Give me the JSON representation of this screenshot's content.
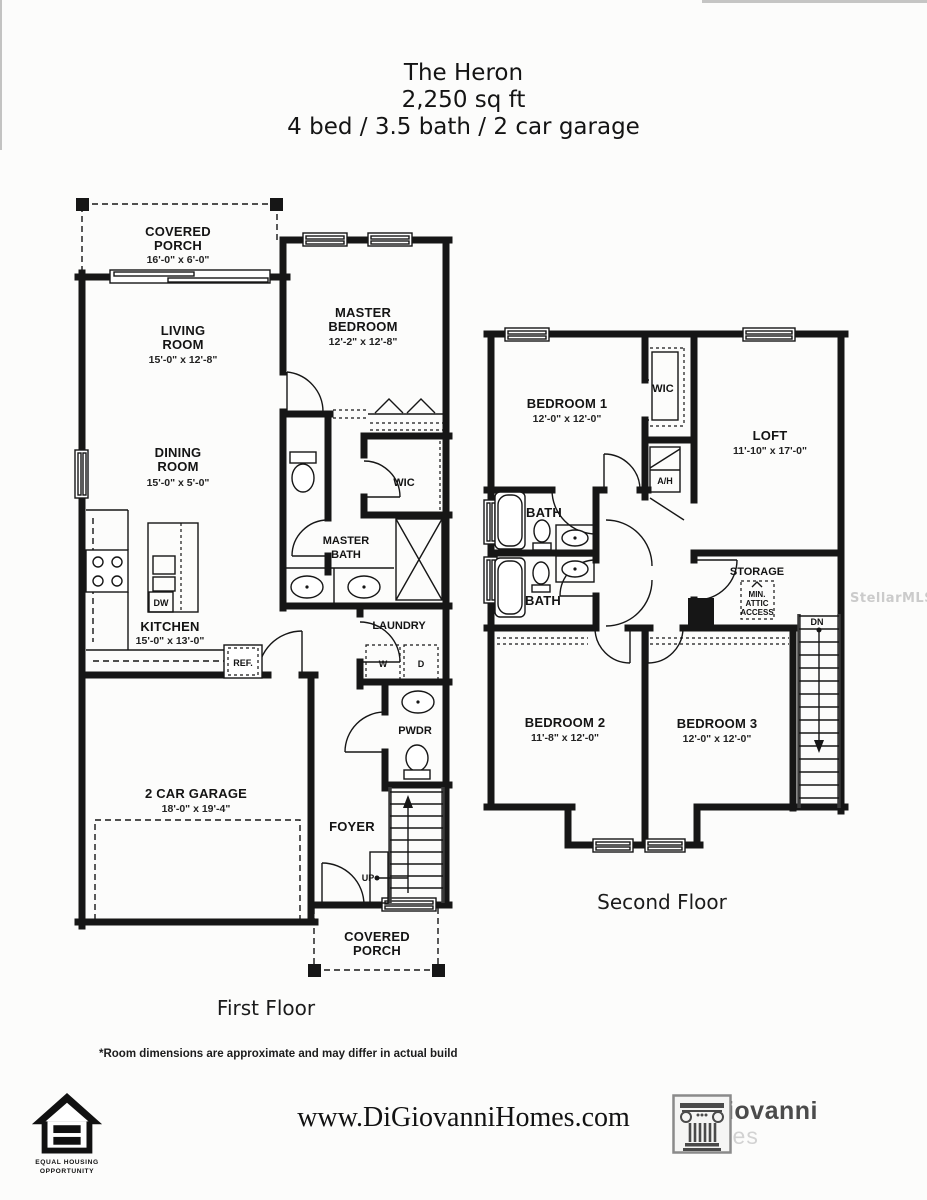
{
  "theme": {
    "ink": "#161616",
    "paper": "#fcfcfb",
    "watermark_color": "#cbcbcb",
    "brand_gray": "#4b4b4b",
    "brand_light_gray": "#d2d2d2"
  },
  "header": {
    "line1": "The Heron",
    "line2": "2,250 sq ft",
    "line3": "4 bed / 3.5 bath / 2 car garage"
  },
  "watermark": "StellarMLS",
  "first_floor": {
    "caption": "First Floor",
    "porch_top": {
      "l1": "COVERED",
      "l2": "PORCH",
      "dims": "16'-0\" x 6'-0\""
    },
    "living": {
      "l1": "LIVING",
      "l2": "ROOM",
      "dims": "15'-0\" x 12'-8\""
    },
    "master_bedroom": {
      "l1": "MASTER",
      "l2": "BEDROOM",
      "dims": "12'-2\" x 12'-8\""
    },
    "dining": {
      "l1": "DINING",
      "l2": "ROOM",
      "dims": "15'-0\" x 5'-0\""
    },
    "wic": "WIC",
    "master_bath": {
      "l1": "MASTER",
      "l2": "BATH"
    },
    "kitchen": {
      "l1": "KITCHEN",
      "dims": "15'-0\" x 13'-0\""
    },
    "dishwasher": "DW",
    "fridge": "REF.",
    "laundry": "LAUNDRY",
    "washer": "W",
    "dryer": "D",
    "pwdr": "PWDR",
    "garage": {
      "l1": "2 CAR GARAGE",
      "dims": "18'-0\" x 19'-4\""
    },
    "foyer": "FOYER",
    "up": "UP",
    "porch_bottom": {
      "l1": "COVERED",
      "l2": "PORCH"
    }
  },
  "second_floor": {
    "caption": "Second Floor",
    "bedroom1": {
      "l1": "BEDROOM 1",
      "dims": "12'-0\" x 12'-0\""
    },
    "wic": "WIC",
    "loft": {
      "l1": "LOFT",
      "dims": "11'-10\" x 17'-0\""
    },
    "ah": "A/H",
    "bath1": "BATH",
    "bath2": "BATH",
    "storage": "STORAGE",
    "attic": {
      "l1": "MIN.",
      "l2": "ATTIC",
      "l3": "ACCESS"
    },
    "dn": "DN",
    "bedroom2": {
      "l1": "BEDROOM 2",
      "dims": "11'-8\" x 12'-0\""
    },
    "bedroom3": {
      "l1": "BEDROOM 3",
      "dims": "12'-0\" x 12'-0\""
    }
  },
  "notes": {
    "footnote": "*Room dimensions are approximate and may differ in actual build"
  },
  "footer": {
    "website": "www.DiGiovanniHomes.com",
    "equal_housing_line1": "EQUAL HOUSING",
    "equal_housing_line2": "OPPORTUNITY",
    "brand_name": "DiGiovanni",
    "brand_sub": "Homes"
  }
}
